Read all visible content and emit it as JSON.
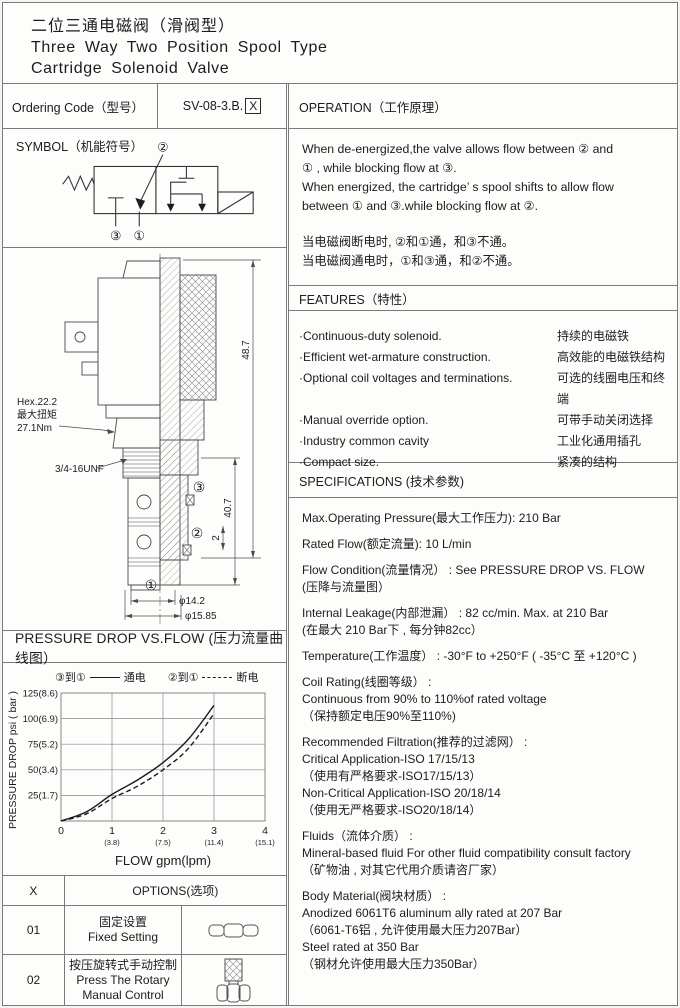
{
  "header": {
    "title_zh": "二位三通电磁阀（滑阀型）",
    "title_en_line1": "Three Way Two Position Spool Type",
    "title_en_line2": "Cartridge Solenoid Valve"
  },
  "ordering": {
    "label": "Ordering Code（型号）",
    "code_prefix": "SV-08-3.B.",
    "code_x": "X"
  },
  "symbol_section": {
    "title": "SYMBOL（机能符号）",
    "port_top": "②",
    "port_bottom_left": "③",
    "port_bottom_right": "①"
  },
  "drawing": {
    "hex_label": "Hex.22.2",
    "torque_label_zh": "最大扭矩",
    "torque_value": "27.1Nm",
    "thread_label": "3/4-16UNF",
    "dim_total_height": "48.7",
    "dim_step": "2",
    "dim_lower_height": "40.7",
    "dim_dia_1": "φ14.2",
    "dim_dia_2": "φ15.85",
    "port_1": "①",
    "port_2": "②",
    "port_3": "③"
  },
  "operation": {
    "title": "OPERATION（工作原理）",
    "en_lines": [
      "When de-energized,the valve allows flow between ② and",
      "① , while blocking flow at ③.",
      "When energized, the cartridge’ s spool shifts to allow flow",
      "between ① and ③.while blocking flow at ②."
    ],
    "zh_lines": [
      "当电磁阀断电时, ②和①通，和③不通。",
      "当电磁阀通电时，①和③通，和②不通。"
    ]
  },
  "features": {
    "title": "FEATURES（特性）",
    "items": [
      {
        "en": "·Continuous-duty  solenoid.",
        "zh": "持续的电磁铁"
      },
      {
        "en": "·Efficient wet-armature construction.",
        "zh": "高效能的电磁铁结构"
      },
      {
        "en": "·Optional coil voltages and terminations.",
        "zh": "可选的线圈电压和终端"
      },
      {
        "en": "·Manual override option.",
        "zh": "可带手动关闭选择"
      },
      {
        "en": "·Industry common cavity",
        "zh": "工业化通用插孔"
      },
      {
        "en": "·Compact size.",
        "zh": "紧凑的结构"
      }
    ]
  },
  "specifications": {
    "title": "SPECIFICATIONS (技术参数)",
    "paragraphs": [
      {
        "lines": [
          "Max.Operating Pressure(最大工作压力): 210 Bar"
        ]
      },
      {
        "lines": [
          "Rated Flow(额定流量): 10 L/min"
        ]
      },
      {
        "lines": [
          "Flow Condition(流量情况） : See PRESSURE DROP VS. FLOW",
          "(压降与流量图）"
        ]
      },
      {
        "lines": [
          "Internal Leakage(内部泄漏） : 82 cc/min. Max. at 210 Bar",
          "(在最大 210 Bar下 , 每分钟82cc）"
        ]
      },
      {
        "lines": [
          "Temperature(工作温度） : -30°F to +250°F  ( -35°C 至 +120°C )"
        ]
      },
      {
        "lines": [
          "Coil Rating(线圈等级） :",
          "Continuous from 90% to 110%of rated voltage",
          "（保持额定电压90%至110%)"
        ]
      },
      {
        "lines": [
          "Recommended Filtration(推荐的过滤网） :",
          "Critical Application-ISO 17/15/13",
          "（使用有严格要求-ISO17/15/13）",
          "Non-Critical Application-ISO 20/18/14",
          "（使用无严格要求-ISO20/18/14）"
        ]
      },
      {
        "lines": [
          "Fluids（流体介质） :",
          "Mineral-based fluid For other  fluid compatibility consult  factory",
          "（矿物油 , 对其它代用介质请咨厂家）"
        ]
      },
      {
        "lines": [
          "Body Material(阀块材质） :",
          "Anodized 6061T6 aluminum ally rated at 207 Bar",
          "（6061-T6铝 , 允许使用最大压力207Bar）",
          "Steel rated at 350 Bar",
          "（钢材允许使用最大压力350Bar）"
        ]
      }
    ]
  },
  "pressure_chart": {
    "title": "PRESSURE DROP VS.FLOW  (压力流量曲线图）",
    "legend": [
      {
        "ports": "③到①",
        "line": "solid",
        "state": "通电"
      },
      {
        "ports": "②到①",
        "line": "dashed",
        "state": "断电"
      }
    ],
    "ylabel": "PRESSURE DROP psi ( bar )",
    "xlabel": "FLOW gpm(lpm)",
    "y_tick_labels": [
      "125(8.6)",
      "100(6.9)",
      "75(5.2)",
      "50(3.4)",
      "25(1.7)"
    ],
    "x_origin_label": "0",
    "x_tick_main": [
      "1",
      "2",
      "3",
      "4"
    ],
    "x_tick_sub": [
      "(3.8)",
      "(7.5)",
      "(11.4)",
      "(15.1)"
    ]
  },
  "chart_data": {
    "type": "line",
    "title": "PRESSURE DROP VS.FLOW（压力流量曲线图）",
    "xlabel": "FLOW gpm(lpm)",
    "ylabel": "PRESSURE DROP psi (bar)",
    "xlim": [
      0,
      4
    ],
    "ylim": [
      0,
      125
    ],
    "grid": true,
    "legend_position": "top",
    "x_tick_secondary_lpm": {
      "1": 3.8,
      "2": 7.5,
      "3": 11.4,
      "4": 15.1
    },
    "y_tick_secondary_bar": {
      "25": 1.7,
      "50": 3.4,
      "75": 5.2,
      "100": 6.9,
      "125": 8.6
    },
    "series": [
      {
        "name": "③到① 通电 (energized)",
        "style": "solid",
        "x": [
          0,
          0.5,
          1,
          1.5,
          2,
          2.5,
          3
        ],
        "y": [
          0,
          9,
          26,
          40,
          57,
          80,
          113
        ]
      },
      {
        "name": "②到① 断电 (de-energized)",
        "style": "dashed",
        "x": [
          0,
          0.5,
          1,
          1.5,
          2,
          2.5,
          3
        ],
        "y": [
          0,
          7,
          22,
          34,
          50,
          71,
          105
        ]
      }
    ]
  },
  "options": {
    "code_header": "X",
    "title": "OPTIONS(选项)",
    "rows": [
      {
        "code": "01",
        "zh": "固定设置",
        "en": "Fixed Setting",
        "icon": "hex-nut-icon"
      },
      {
        "code": "02",
        "zh": "按压旋转式手动控制",
        "en": "Press The Rotary Manual Control",
        "icon": "knurled-knob-icon"
      }
    ]
  }
}
